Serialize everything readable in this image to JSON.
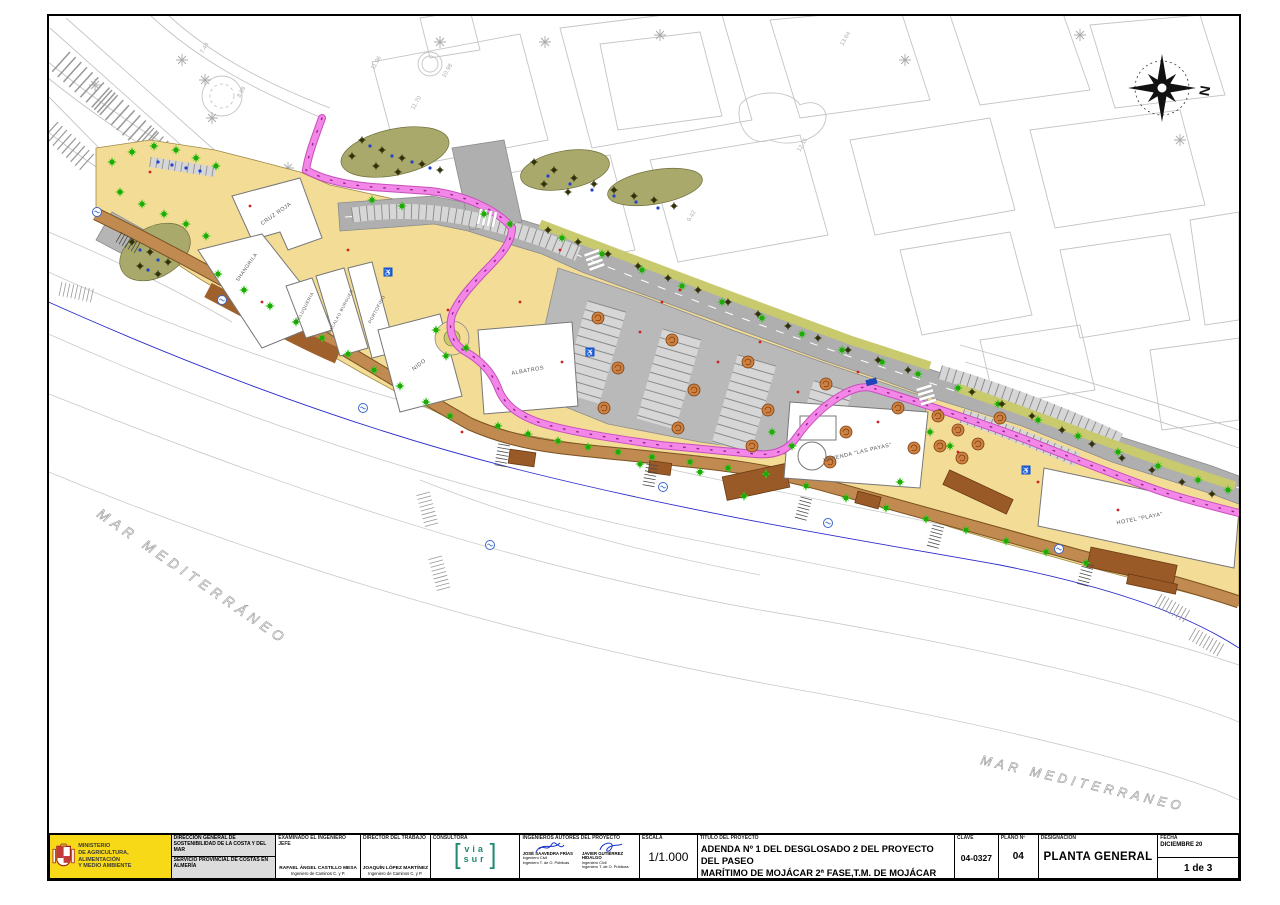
{
  "palette": {
    "sand": "#F2DC96",
    "road_gray": "#AFAFAF",
    "bike_pink": "#F287E8",
    "boardwalk_brown": "#C08A50",
    "deck_brown": "#9A5A28",
    "tree_green": "#2ECB12",
    "planting_olive": "#A9A96B",
    "grass_strip": "#C9C96E",
    "sea_line_blue": "#2B2BCC",
    "ministry_yellow": "#F7D917",
    "viasur_teal": "#1F8A70",
    "signature_blue": "#1535C9"
  },
  "compass": {
    "label": "N"
  },
  "sea": {
    "left": "MAR MEDITERRÁNEO",
    "right": "MAR MEDITERRANEO"
  },
  "map": {
    "buildings": [
      {
        "label": "CRUZ ROJA"
      },
      {
        "label": "SHANGRILA"
      },
      {
        "label": "PELUQUERIA"
      },
      {
        "label": "BACALAO BURGUER"
      },
      {
        "label": "PORTOFINO"
      },
      {
        "label": "NIDO"
      },
      {
        "label": "ALBATROS"
      },
      {
        "label": "VIVIENDA \"LAS PAYAS\""
      },
      {
        "label": "HOTEL \"PLAYA\""
      }
    ],
    "spot_elevations": [
      "13.64",
      "12.11",
      "11.06",
      "10.98",
      "11.70",
      "9.42",
      "8.99",
      "7.44"
    ]
  },
  "title_block": {
    "ministry": {
      "line1": "MINISTERIO",
      "line2": "DE AGRICULTURA, ALIMENTACIÓN",
      "line3": "Y MEDIO AMBIENTE"
    },
    "direccion_general": "DIRECCIÓN GENERAL DE SOSTENIBILIDAD DE LA COSTA Y DEL MAR",
    "servicio": "SERVICIO PROVINCIAL DE COSTAS EN ALMERÍA",
    "examinado": {
      "header": "EXAMINADO EL INGENIERO JEFE",
      "name": "RAFAEL ÁNGEL CASTILLO MESA",
      "title": "Ingeniero de Caminos C. y P."
    },
    "director": {
      "header": "DIRECTOR DEL TRABAJO",
      "name": "JOAQUÍN LÓPEZ MARTÍNEZ",
      "title": "Ingeniero de Caminos C. y P."
    },
    "consultora": {
      "header": "CONSULTORA",
      "logo_top": "via",
      "logo_bottom": "sur"
    },
    "autores": {
      "header": "INGENIEROS AUTORES DEL PROYECTO",
      "engineers": [
        {
          "name": "JOSÉ SAAVEDRA FRÍAS",
          "line1": "Ingeniero Civil",
          "line2": "Ingeniero T. de O. Públicas"
        },
        {
          "name": "JAVIER GUTIÉRREZ HIDALGO",
          "line1": "Ingeniero Civil",
          "line2": "Ingeniero T. de O. Públicas"
        }
      ]
    },
    "escala": {
      "header": "ESCALA",
      "value": "1/1.000"
    },
    "titulo": {
      "header": "TITULO DEL PROYECTO",
      "line1": "ADENDA Nº 1 DEL DESGLOSADO 2 DEL PROYECTO DEL PASEO",
      "line2": "MARÍTIMO DE MOJÁCAR 2ª FASE,T.M. DE MOJÁCAR (ALMERÍA)"
    },
    "clave": {
      "header": "CLAVE",
      "value": "04-0327"
    },
    "plano": {
      "header": "PLANO Nº",
      "value": "04"
    },
    "designacion": {
      "header": "DESIGNACIÓN",
      "value": "PLANTA GENERAL"
    },
    "fecha": {
      "header": "FECHA",
      "value": "DICIEMBRE 20",
      "sheet": "1 de 3"
    }
  }
}
